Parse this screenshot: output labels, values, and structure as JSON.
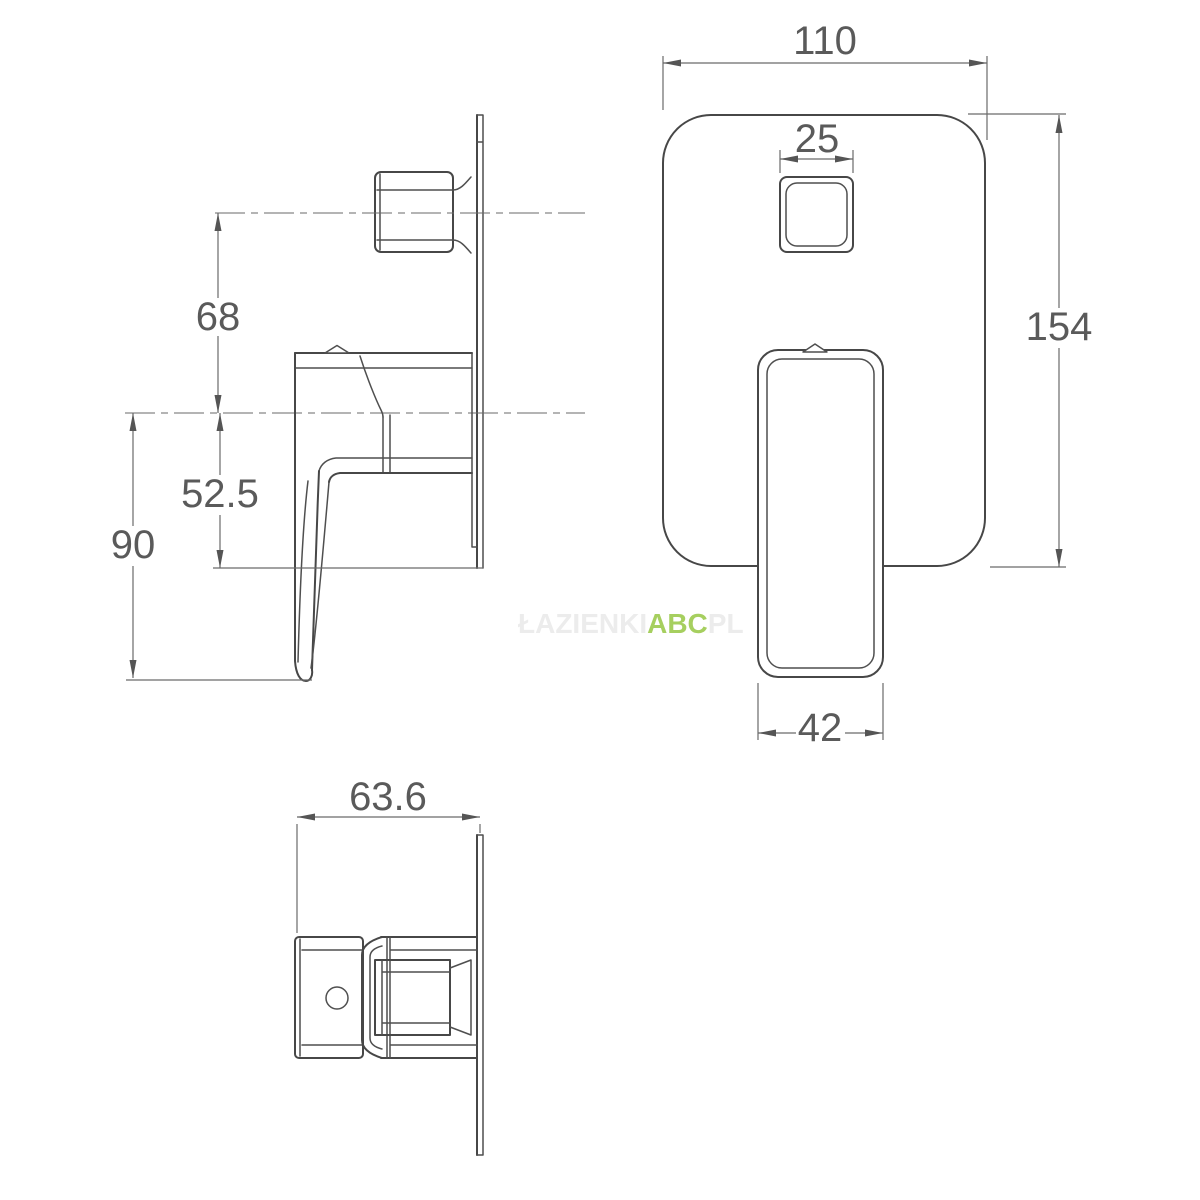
{
  "drawing": {
    "type": "technical-dimension-drawing",
    "subject": "concealed shower mixer valve, three orthographic views"
  },
  "dims": {
    "plate_width": "110",
    "button_width": "25",
    "plate_height": "154",
    "handle_width": "42",
    "knob_axis_offset": "68",
    "axis_to_plate_bottom": "52.5",
    "axis_to_handle_tip": "90",
    "depth": "63.6"
  },
  "watermark": {
    "prefix": "ŁAZIENKI",
    "brand": "ABC",
    "suffix": "PL"
  },
  "colors": {
    "object_line": "#474747",
    "dimension_line": "#6a6a6a",
    "dimension_text": "#5a5a5a",
    "watermark_brand": "#a6cf5f",
    "watermark_faint": "#ececec",
    "background": "#ffffff"
  }
}
